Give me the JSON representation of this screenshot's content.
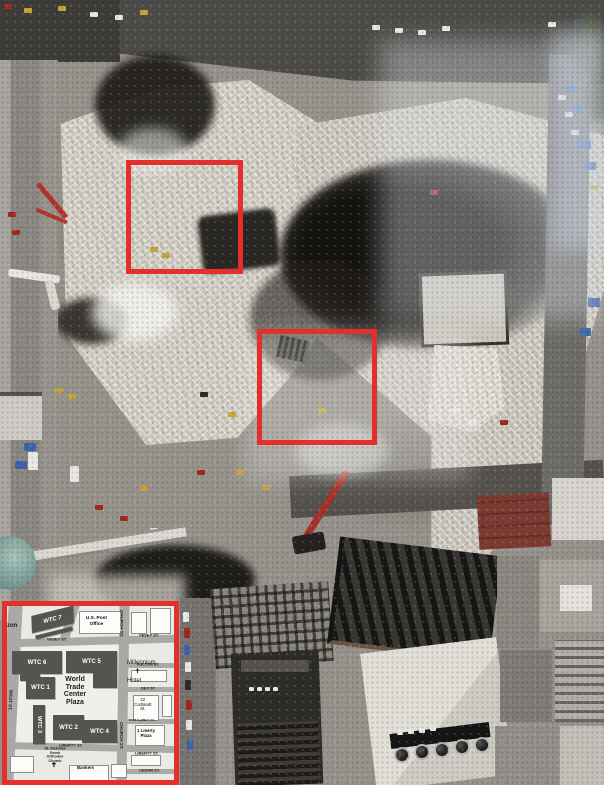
{
  "colors": {
    "annotation_red": "#e4302d"
  },
  "inset_map": {
    "plaza_label": "World\nTrade\nCenter\nPlaza",
    "buildings": {
      "wtc7": "WTC 7",
      "wtc6": "WTC 6",
      "wtc5": "WTC 5",
      "wtc1": "WTC 1",
      "wtc2": "WTC 2",
      "wtc3": "WTC 3",
      "wtc4": "WTC 4",
      "post_office": "U.S. Post Office",
      "millennium_hotel": "Millennium\nHotel",
      "cortlandt_22": "22\nCortlandt\nSt.",
      "one_liberty_plaza": "1 Liberty\nPlaza",
      "bankers": "Bankers",
      "st_nicholas": "St. Nicholas\nGreek Orthodox\nChurch",
      "west_90": "90 West St.",
      "edge_fragment": "zon"
    },
    "streets": {
      "vesey_left": "VESEY ST.",
      "vesey_right": "VESEY ST.",
      "church_upper": "CHURCH ST.",
      "church_lower": "CHURCH ST.",
      "west": "WEST ST.",
      "fulton": "FULTON ST.",
      "dey": "DEY ST.",
      "cortlandt": "CORTLANDT ST.",
      "liberty_left": "LIBERTY ST.",
      "liberty_right": "LIBERTY ST.",
      "cedar": "CEDAR ST."
    },
    "icons": {
      "chapel_cross": "✝",
      "church_cross": "✝"
    }
  }
}
